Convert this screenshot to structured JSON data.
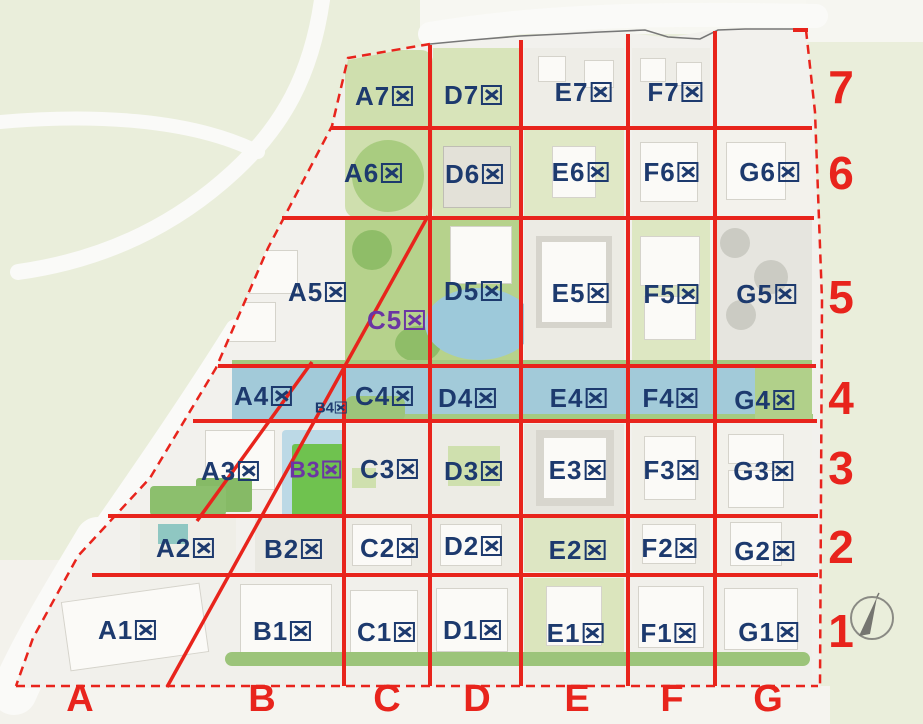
{
  "title": "site-zoning-grid-map",
  "colors": {
    "grid_red": "#e8241c",
    "zone_navy": "#1d3a6e",
    "zone_purple": "#6b35a3",
    "water_blue": "#a2cad9",
    "park_green": "#b5d28b",
    "outside_green": "#eaeedb"
  },
  "zones": {
    "navy": [
      {
        "label": "A7区",
        "x": 384,
        "y": 96
      },
      {
        "label": "D7区",
        "x": 473,
        "y": 95
      },
      {
        "label": "E7区",
        "x": 583,
        "y": 92
      },
      {
        "label": "F7区",
        "x": 675,
        "y": 92
      },
      {
        "label": "A6区",
        "x": 373,
        "y": 173
      },
      {
        "label": "D6区",
        "x": 474,
        "y": 174
      },
      {
        "label": "E6区",
        "x": 580,
        "y": 172
      },
      {
        "label": "F6区",
        "x": 671,
        "y": 172
      },
      {
        "label": "G6区",
        "x": 769,
        "y": 172
      },
      {
        "label": "A5区",
        "x": 317,
        "y": 292
      },
      {
        "label": "D5区",
        "x": 473,
        "y": 291
      },
      {
        "label": "E5区",
        "x": 580,
        "y": 293
      },
      {
        "label": "F5区",
        "x": 671,
        "y": 294
      },
      {
        "label": "G5区",
        "x": 766,
        "y": 294
      },
      {
        "label": "A4区",
        "x": 263,
        "y": 396
      },
      {
        "label": "C4区",
        "x": 384,
        "y": 396
      },
      {
        "label": "D4区",
        "x": 467,
        "y": 398
      },
      {
        "label": "E4区",
        "x": 578,
        "y": 398
      },
      {
        "label": "F4区",
        "x": 670,
        "y": 398
      },
      {
        "label": "G4区",
        "x": 764,
        "y": 400
      },
      {
        "label": "A3区",
        "x": 230,
        "y": 471
      },
      {
        "label": "C3区",
        "x": 389,
        "y": 469
      },
      {
        "label": "D3区",
        "x": 473,
        "y": 471
      },
      {
        "label": "E3区",
        "x": 577,
        "y": 470
      },
      {
        "label": "F3区",
        "x": 671,
        "y": 470
      },
      {
        "label": "G3区",
        "x": 763,
        "y": 471
      },
      {
        "label": "A2区",
        "x": 185,
        "y": 548
      },
      {
        "label": "B2区",
        "x": 293,
        "y": 549
      },
      {
        "label": "C2区",
        "x": 389,
        "y": 548
      },
      {
        "label": "D2区",
        "x": 473,
        "y": 546
      },
      {
        "label": "E2区",
        "x": 577,
        "y": 550
      },
      {
        "label": "F2区",
        "x": 669,
        "y": 548
      },
      {
        "label": "G2区",
        "x": 764,
        "y": 551
      },
      {
        "label": "A1区",
        "x": 127,
        "y": 630
      },
      {
        "label": "B1区",
        "x": 282,
        "y": 631
      },
      {
        "label": "C1区",
        "x": 386,
        "y": 632
      },
      {
        "label": "D1区",
        "x": 472,
        "y": 630
      },
      {
        "label": "E1区",
        "x": 575,
        "y": 633
      },
      {
        "label": "F1区",
        "x": 668,
        "y": 633
      },
      {
        "label": "G1区",
        "x": 768,
        "y": 632
      }
    ],
    "purple": [
      {
        "label": "C5区",
        "x": 396,
        "y": 320,
        "size": "purple"
      },
      {
        "label": "B3区",
        "x": 315,
        "y": 470,
        "size": "purple b3size"
      }
    ],
    "small": [
      {
        "label": "B4区",
        "x": 331,
        "y": 408
      }
    ]
  },
  "row_numbers": [
    {
      "label": "7",
      "y": 87
    },
    {
      "label": "6",
      "y": 173
    },
    {
      "label": "5",
      "y": 297
    },
    {
      "label": "4",
      "y": 398
    },
    {
      "label": "3",
      "y": 468
    },
    {
      "label": "2",
      "y": 547
    },
    {
      "label": "1",
      "y": 631
    }
  ],
  "col_letters": [
    {
      "label": "A",
      "x": 80
    },
    {
      "label": "B",
      "x": 262
    },
    {
      "label": "C",
      "x": 387
    },
    {
      "label": "D",
      "x": 477
    },
    {
      "label": "E",
      "x": 577
    },
    {
      "label": "F",
      "x": 672
    },
    {
      "label": "G",
      "x": 768
    }
  ]
}
